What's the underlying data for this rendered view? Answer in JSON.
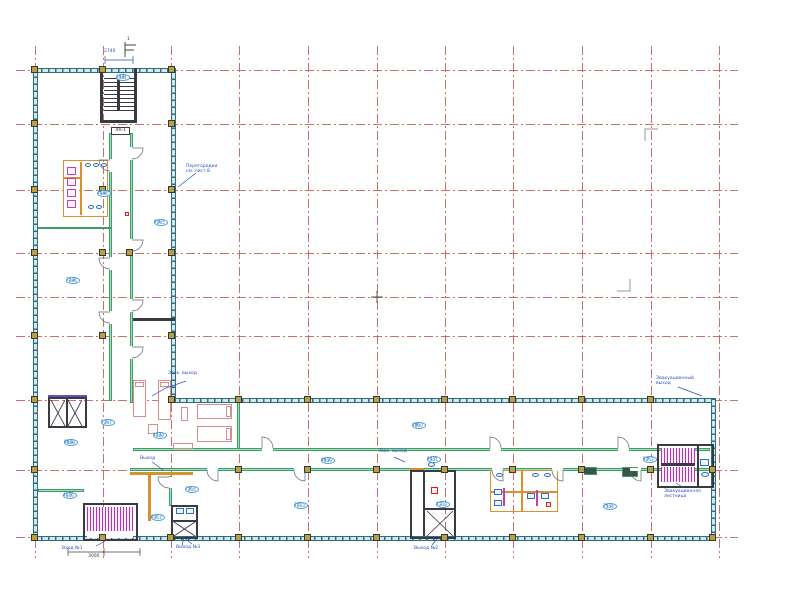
{
  "drawing": {
    "title": "floor-plan-sheet"
  },
  "grid": {
    "cols": [
      35,
      103,
      171,
      239,
      308,
      377,
      445,
      513,
      582,
      651,
      719
    ],
    "rows": [
      70,
      124,
      190,
      253,
      297,
      336,
      400,
      470,
      537
    ],
    "col_span": [
      46,
      558
    ],
    "row_span": [
      16,
      738
    ],
    "color": "#c4554d"
  },
  "rects": {
    "tw_h": [
      [
        33,
        68,
        143,
        5
      ],
      [
        171,
        398,
        545,
        5
      ],
      [
        33,
        536,
        683,
        5
      ]
    ],
    "tw_v": [
      [
        33,
        68,
        5,
        473
      ],
      [
        171,
        68,
        5,
        335
      ],
      [
        711,
        398,
        5,
        143
      ]
    ],
    "gw": [
      [
        109,
        133,
        3,
        268
      ],
      [
        130,
        133,
        3,
        270
      ],
      [
        237,
        401,
        3,
        48
      ],
      [
        133,
        448,
        577,
        3
      ],
      [
        130,
        468,
        581,
        3
      ],
      [
        38,
        489,
        46,
        3
      ],
      [
        169,
        476,
        3,
        30
      ],
      [
        38,
        227,
        73,
        2
      ]
    ],
    "gd": [
      [
        622,
        467,
        16,
        10
      ],
      [
        584,
        467,
        13,
        8
      ]
    ],
    "obox": [
      [
        63,
        160,
        45,
        57
      ],
      [
        490,
        470,
        68,
        42
      ]
    ],
    "ow": [
      [
        80,
        162,
        2,
        53
      ],
      [
        63,
        177,
        18,
        2
      ],
      [
        521,
        470,
        2,
        42
      ],
      [
        490,
        491,
        32,
        2
      ],
      [
        522,
        491,
        36,
        2
      ],
      [
        130,
        472,
        63,
        3
      ],
      [
        148,
        475,
        3,
        46
      ],
      [
        410,
        468,
        14,
        3
      ]
    ],
    "dbox": [
      [
        48,
        397,
        39,
        31
      ],
      [
        83,
        503,
        55,
        38
      ],
      [
        171,
        505,
        27,
        34
      ],
      [
        410,
        470,
        46,
        69
      ],
      [
        657,
        444,
        57,
        44
      ]
    ],
    "dw": [
      [
        100,
        68,
        3,
        55
      ],
      [
        134,
        68,
        3,
        55
      ],
      [
        100,
        120,
        37,
        3
      ],
      [
        133,
        318,
        42,
        3
      ],
      [
        66,
        399,
        2,
        28
      ],
      [
        172,
        520,
        25,
        2
      ],
      [
        423,
        472,
        2,
        64
      ],
      [
        424,
        508,
        32,
        2
      ],
      [
        697,
        446,
        2,
        40
      ],
      [
        117,
        78,
        3,
        33
      ],
      [
        661,
        463,
        34,
        3
      ]
    ],
    "pw": [
      [
        48,
        395,
        39,
        2
      ]
    ],
    "hv": [
      [
        87,
        507,
        46,
        24
      ],
      [
        661,
        448,
        34,
        15
      ],
      [
        661,
        467,
        34,
        15
      ]
    ],
    "hh": [
      [
        104,
        78,
        30,
        33
      ]
    ],
    "white": [
      [
        87,
        531,
        46,
        7
      ],
      [
        109,
        159,
        3,
        13
      ],
      [
        109,
        257,
        3,
        13
      ],
      [
        109,
        311,
        3,
        13
      ],
      [
        130,
        147,
        3,
        13
      ],
      [
        130,
        239,
        3,
        13
      ],
      [
        130,
        299,
        3,
        13
      ],
      [
        130,
        346,
        3,
        13
      ],
      [
        262,
        448,
        11,
        3
      ],
      [
        490,
        448,
        11,
        3
      ],
      [
        618,
        448,
        11,
        3
      ],
      [
        207,
        468,
        11,
        3
      ],
      [
        294,
        468,
        11,
        3
      ],
      [
        492,
        468,
        11,
        3
      ],
      [
        552,
        468,
        11,
        3
      ],
      [
        630,
        468,
        11,
        3
      ],
      [
        169,
        477,
        3,
        11
      ]
    ],
    "fur": [
      [
        133,
        380,
        13,
        37
      ],
      [
        158,
        380,
        13,
        40
      ],
      [
        197,
        404,
        35,
        15
      ],
      [
        197,
        426,
        35,
        16
      ],
      [
        173,
        443,
        20,
        6
      ],
      [
        148,
        424,
        10,
        10
      ],
      [
        181,
        407,
        7,
        14
      ]
    ],
    "pk": [
      [
        135,
        382,
        9,
        5
      ],
      [
        160,
        382,
        9,
        5
      ],
      [
        226,
        406,
        5,
        11
      ],
      [
        226,
        428,
        5,
        12
      ]
    ],
    "st": [
      [
        67,
        167,
        9,
        8
      ],
      [
        67,
        178,
        9,
        8
      ],
      [
        67,
        189,
        9,
        8
      ],
      [
        67,
        200,
        9,
        8
      ],
      [
        503,
        488,
        2,
        18
      ],
      [
        536,
        490,
        2,
        16
      ]
    ],
    "bo": [
      [
        85,
        163,
        6,
        4
      ],
      [
        93,
        163,
        6,
        4
      ],
      [
        101,
        163,
        6,
        4
      ],
      [
        88,
        205,
        6,
        4
      ],
      [
        96,
        205,
        6,
        4
      ],
      [
        496,
        473,
        7,
        4
      ],
      [
        532,
        473,
        7,
        4
      ],
      [
        544,
        473,
        7,
        4
      ],
      [
        701,
        472,
        8,
        5
      ],
      [
        428,
        462,
        7,
        5
      ]
    ],
    "br": [
      [
        494,
        489,
        8,
        6
      ],
      [
        494,
        500,
        8,
        6
      ],
      [
        527,
        493,
        8,
        6
      ],
      [
        541,
        493,
        8,
        6
      ],
      [
        700,
        459,
        9,
        7
      ],
      [
        176,
        508,
        8,
        6
      ],
      [
        186,
        508,
        8,
        6
      ]
    ],
    "rm": [
      [
        431,
        487,
        7,
        7
      ],
      [
        546,
        502,
        5,
        5
      ],
      [
        125,
        212,
        4,
        4
      ]
    ]
  },
  "columns": [
    [
      35,
      70
    ],
    [
      103,
      70
    ],
    [
      172,
      70
    ],
    [
      35,
      124
    ],
    [
      172,
      124
    ],
    [
      35,
      190
    ],
    [
      103,
      190
    ],
    [
      172,
      190
    ],
    [
      35,
      253
    ],
    [
      103,
      253
    ],
    [
      130,
      253
    ],
    [
      172,
      253
    ],
    [
      35,
      336
    ],
    [
      103,
      336
    ],
    [
      172,
      336
    ],
    [
      35,
      400
    ],
    [
      172,
      400
    ],
    [
      239,
      400
    ],
    [
      308,
      400
    ],
    [
      377,
      400
    ],
    [
      445,
      400
    ],
    [
      513,
      400
    ],
    [
      582,
      400
    ],
    [
      651,
      400
    ],
    [
      35,
      470
    ],
    [
      239,
      470
    ],
    [
      308,
      470
    ],
    [
      377,
      470
    ],
    [
      445,
      470
    ],
    [
      513,
      470
    ],
    [
      582,
      470
    ],
    [
      651,
      470
    ],
    [
      713,
      470
    ],
    [
      35,
      538
    ],
    [
      103,
      538
    ],
    [
      171,
      538
    ],
    [
      239,
      538
    ],
    [
      308,
      538
    ],
    [
      377,
      538
    ],
    [
      445,
      538
    ],
    [
      513,
      538
    ],
    [
      582,
      538
    ],
    [
      651,
      538
    ],
    [
      713,
      538
    ]
  ],
  "stair_label": {
    "x": 111,
    "y": 127,
    "w": 19,
    "h": 8,
    "text": "ЛК-1"
  },
  "section_mark": {
    "x": 127,
    "y": 37,
    "text": "1"
  },
  "tags": [
    {
      "x": 116,
      "y": 74,
      "label": "201",
      "sub": "14,6"
    },
    {
      "x": 97,
      "y": 190,
      "label": "204",
      "sub": "16,8"
    },
    {
      "x": 154,
      "y": 219,
      "label": "205",
      "sub": "9,4"
    },
    {
      "x": 66,
      "y": 277,
      "label": "206",
      "sub": "72,3"
    },
    {
      "x": 101,
      "y": 419,
      "label": "207",
      "sub": "5,2"
    },
    {
      "x": 64,
      "y": 439,
      "label": "208",
      "sub": "68,5"
    },
    {
      "x": 153,
      "y": 432,
      "label": "209",
      "sub": "12,1"
    },
    {
      "x": 412,
      "y": 422,
      "label": "210",
      "sub": "186"
    },
    {
      "x": 427,
      "y": 456,
      "label": "211",
      "sub": "94,7"
    },
    {
      "x": 643,
      "y": 456,
      "label": "212",
      "sub": "8,9"
    },
    {
      "x": 294,
      "y": 502,
      "label": "213",
      "sub": "215"
    },
    {
      "x": 603,
      "y": 503,
      "label": "214",
      "sub": "74,2"
    },
    {
      "x": 63,
      "y": 492,
      "label": "215",
      "sub": "41,6"
    },
    {
      "x": 185,
      "y": 486,
      "label": "216",
      "sub": "7,8"
    },
    {
      "x": 151,
      "y": 514,
      "label": "217",
      "sub": "6,3"
    },
    {
      "x": 436,
      "y": 501,
      "label": "218",
      "sub": "4,1"
    },
    {
      "x": 321,
      "y": 457,
      "label": "219",
      "sub": "88,2"
    }
  ],
  "annotations": [
    {
      "x": 104,
      "y": 49,
      "cls": "",
      "lines": [
        "2740"
      ]
    },
    {
      "x": 186,
      "y": 164,
      "cls": "",
      "lines": [
        "Перегородки",
        "см. лист 8"
      ]
    },
    {
      "x": 168,
      "y": 371,
      "cls": "",
      "lines": [
        "Эвак. выход"
      ]
    },
    {
      "x": 656,
      "y": 376,
      "cls": "",
      "lines": [
        "Эвакуационный",
        "выход"
      ]
    },
    {
      "x": 664,
      "y": 489,
      "cls": "",
      "lines": [
        "Эвакуационная",
        "лестница"
      ]
    },
    {
      "x": 414,
      "y": 546,
      "cls": "",
      "lines": [
        "Выход №2"
      ]
    },
    {
      "x": 62,
      "y": 546,
      "cls": "",
      "lines": [
        "Вход №1"
      ]
    },
    {
      "x": 176,
      "y": 545,
      "cls": "",
      "lines": [
        "Выход №3"
      ]
    },
    {
      "x": 378,
      "y": 449,
      "cls": "",
      "lines": [
        "Эвак. выход"
      ]
    },
    {
      "x": 140,
      "y": 456,
      "cls": "",
      "lines": [
        "Выход"
      ]
    },
    {
      "x": 88,
      "y": 554,
      "cls": "dimd",
      "lines": [
        "3000"
      ]
    }
  ],
  "paths": [
    {
      "d": "M110,160 L99,160 A11,11 0 0 0 110,171",
      "s": "#5a6a72",
      "w": 0.7
    },
    {
      "d": "M110,258 L99,258 A11,11 0 0 0 110,269",
      "s": "#5a6a72",
      "w": 0.7
    },
    {
      "d": "M110,312 L99,312 A11,11 0 0 0 110,323",
      "s": "#5a6a72",
      "w": 0.7
    },
    {
      "d": "M132,148 L143,148 A11,11 0 0 1 132,159",
      "s": "#5a6a72",
      "w": 0.7
    },
    {
      "d": "M132,240 L143,240 A11,11 0 0 1 132,251",
      "s": "#5a6a72",
      "w": 0.7
    },
    {
      "d": "M132,300 L143,300 A11,11 0 0 1 132,311",
      "s": "#5a6a72",
      "w": 0.7
    },
    {
      "d": "M132,347 L143,347 A11,11 0 0 1 132,358",
      "s": "#5a6a72",
      "w": 0.7
    },
    {
      "d": "M262,448 L262,437 A11,11 0 0 1 273,448",
      "s": "#5a6a72",
      "w": 0.7
    },
    {
      "d": "M490,448 L490,437 A11,11 0 0 1 501,448",
      "s": "#5a6a72",
      "w": 0.7
    },
    {
      "d": "M618,448 L618,437 A11,11 0 0 1 629,448",
      "s": "#5a6a72",
      "w": 0.7
    },
    {
      "d": "M218,470 L218,481 A11,11 0 0 1 207,470",
      "s": "#5a6a72",
      "w": 0.7
    },
    {
      "d": "M305,470 L305,481 A11,11 0 0 1 294,470",
      "s": "#5a6a72",
      "w": 0.7
    },
    {
      "d": "M503,470 L503,481 A11,11 0 0 1 492,470",
      "s": "#5a6a72",
      "w": 0.7
    },
    {
      "d": "M563,470 L563,481 A11,11 0 0 1 552,470",
      "s": "#5a6a72",
      "w": 0.7
    },
    {
      "d": "M641,470 L641,481 A11,11 0 0 1 630,470",
      "s": "#5a6a72",
      "w": 0.7
    },
    {
      "d": "M169,477 L158,477 A11,11 0 0 0 169,488",
      "s": "#5a6a72",
      "w": 0.7
    },
    {
      "d": "M186,381 L166,388 L152,396",
      "s": "#2b4fc0",
      "w": 0.7
    },
    {
      "d": "M678,387 L702,396",
      "s": "#2b4fc0",
      "w": 0.7
    },
    {
      "d": "M684,488 L676,483",
      "s": "#2b4fc0",
      "w": 0.7
    },
    {
      "d": "M432,545 L437,539",
      "s": "#2b4fc0",
      "w": 0.7
    },
    {
      "d": "M96,546 L107,540",
      "s": "#2b4fc0",
      "w": 0.7
    },
    {
      "d": "M192,544 L186,539",
      "s": "#2b4fc0",
      "w": 0.7
    },
    {
      "d": "M196,173 L178,187",
      "s": "#2b4fc0",
      "w": 0.7
    },
    {
      "d": "M394,457 L405,462",
      "s": "#2b4fc0",
      "w": 0.7
    },
    {
      "d": "M152,462 L163,470",
      "s": "#2b4fc0",
      "w": 0.7
    },
    {
      "d": "M184,537 L182,546",
      "s": "#2b4fc0",
      "w": 0.7
    },
    {
      "d": "M105,60 L133,60 M105,56 L105,64 M133,56 L133,64",
      "s": "#2b4fc0",
      "w": 0.7
    },
    {
      "d": "M68,552 L140,552 M68,548 L68,556 M104,548 L104,556 M140,548 L140,556",
      "s": "#444444",
      "w": 0.7
    },
    {
      "d": "M645,141 L645,129 L658,129",
      "s": "#999999",
      "w": 1
    },
    {
      "d": "M630,279 L630,291 L617,291",
      "s": "#999999",
      "w": 1
    },
    {
      "d": "M371,297 L383,297 M377,291 L377,303",
      "s": "#555555",
      "w": 1
    },
    {
      "d": "M125,42 L125,57 M125,45 L136,45 M125,50 L134,50",
      "s": "#444444",
      "w": 1
    },
    {
      "d": "M51,400 L65,426 M65,400 L51,426",
      "s": "#333344",
      "w": 0.8
    },
    {
      "d": "M68,400 L82,426 M82,400 L68,426",
      "s": "#333344",
      "w": 0.8
    },
    {
      "d": "M174,522 L195,536 M195,522 L174,536",
      "s": "#333344",
      "w": 0.8
    },
    {
      "d": "M427,511 L453,536 M453,511 L427,536",
      "s": "#333344",
      "w": 0.8
    }
  ]
}
